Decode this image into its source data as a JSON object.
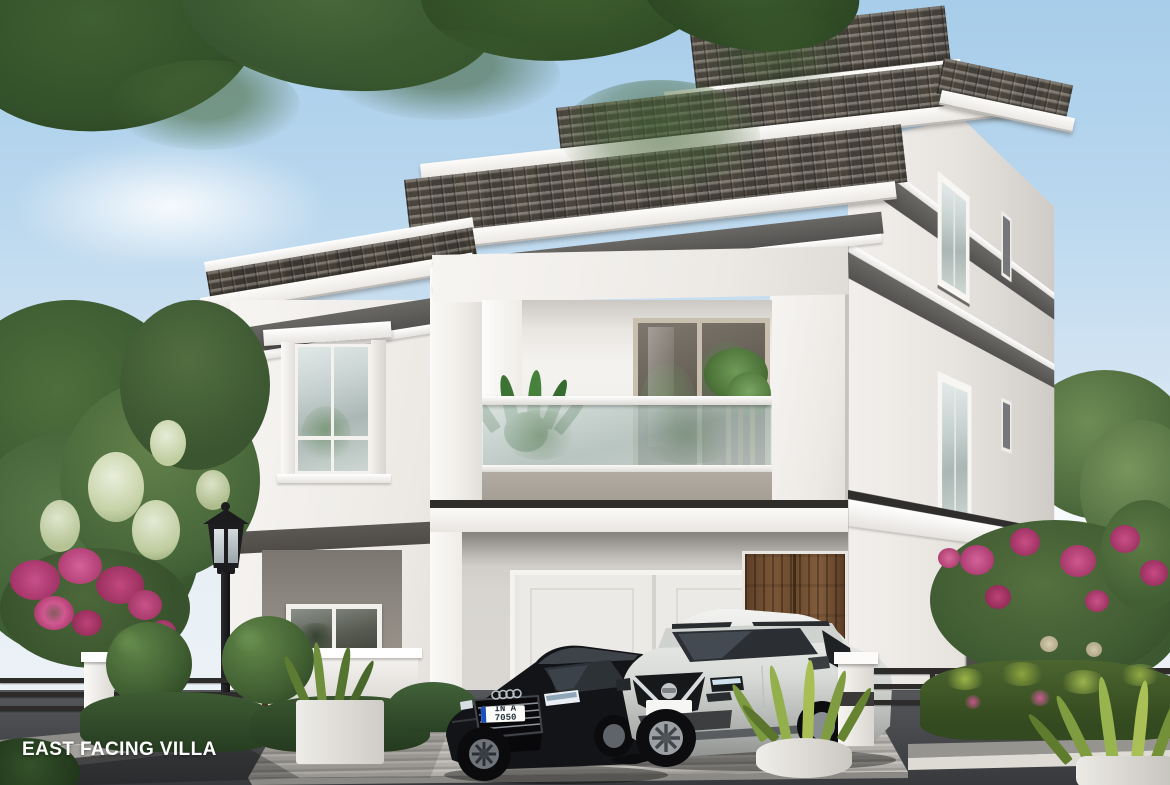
{
  "caption": "EAST FACING VILLA",
  "vehicles": {
    "sedan": {
      "color_name": "black",
      "badge": "audi-rings",
      "license_plate": "IN A 7050"
    },
    "suv": {
      "color_name": "pearl-white",
      "badge": "nissan",
      "license_plate": ""
    }
  },
  "palette": {
    "sky_top": "#a7cdea",
    "sky_horizon": "#eaf1f6",
    "roof_tile": "#6b655c",
    "fascia": "#f6f4f1",
    "wall": "#f2efec",
    "wall_shade": "#d9d6d2",
    "accent_band": "#5b5a57",
    "parapet": "#a8a196",
    "balcony_glass": "#ccd6d4",
    "wood_door": "#6f4e30",
    "foliage_dark": "#2f4727",
    "foliage_mid": "#49683a",
    "foliage_light": "#66874c",
    "blossom": "#e6ebd4",
    "flower_pink": "#c84e85",
    "road": "#3e4043",
    "driveway": "#b2afaa",
    "curb": "#dedbd5",
    "railing": "#2e2d2b",
    "lamp_post": "#1c1c1f"
  },
  "scene": {
    "type": "architectural-exterior-render",
    "subject": "three-storey white villa with grey tiled roofs, glass-railed balcony, carport with two parked cars, landscaped garden, street lamp and compound wall",
    "objects": [
      "sky",
      "clouds",
      "overhanging-branch",
      "garden-trees",
      "bougainvillea",
      "villa",
      "balcony",
      "carport",
      "wooden-entrance-door",
      "black-sedan",
      "white-suv",
      "street-lamp",
      "compound-wall",
      "metal-fence",
      "topiary-bushes",
      "hedge",
      "planters",
      "driveway",
      "road"
    ]
  }
}
